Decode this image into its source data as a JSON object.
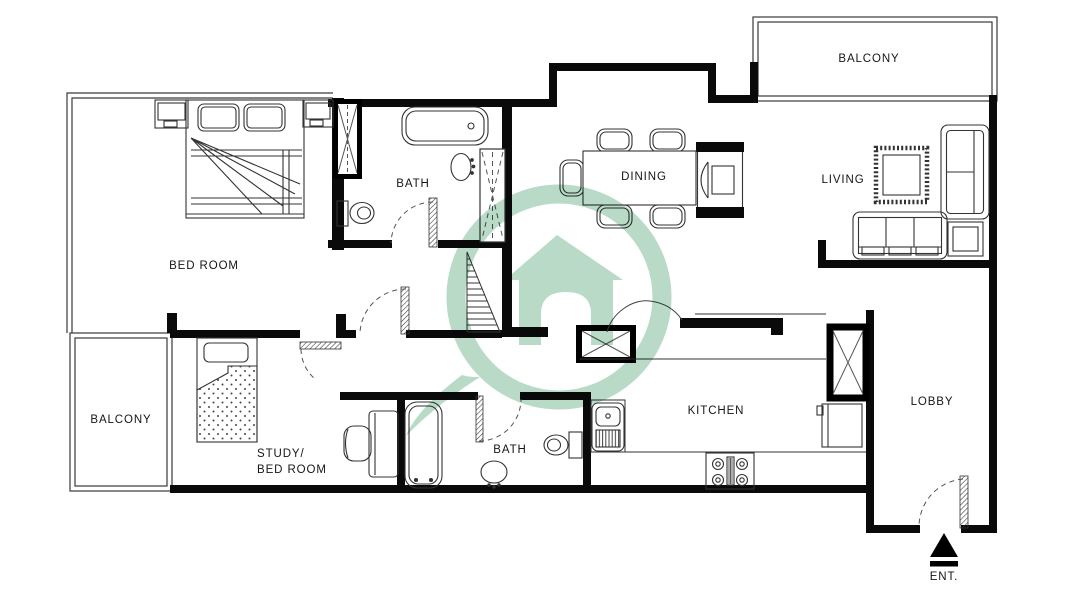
{
  "plan": {
    "watermark_color": "#b8dac7",
    "wall_color": "#0a0a0a",
    "labels": {
      "bedroom": "BED ROOM",
      "bath_top": "BATH",
      "bath_bottom": "BATH",
      "dining": "DINING",
      "living": "LIVING",
      "balcony_top": "BALCONY",
      "balcony_left": "BALCONY",
      "study_line1": "STUDY/",
      "study_line2": "BED ROOM",
      "kitchen": "KITCHEN",
      "lobby": "LOBBY",
      "entrance": "ENT."
    }
  }
}
